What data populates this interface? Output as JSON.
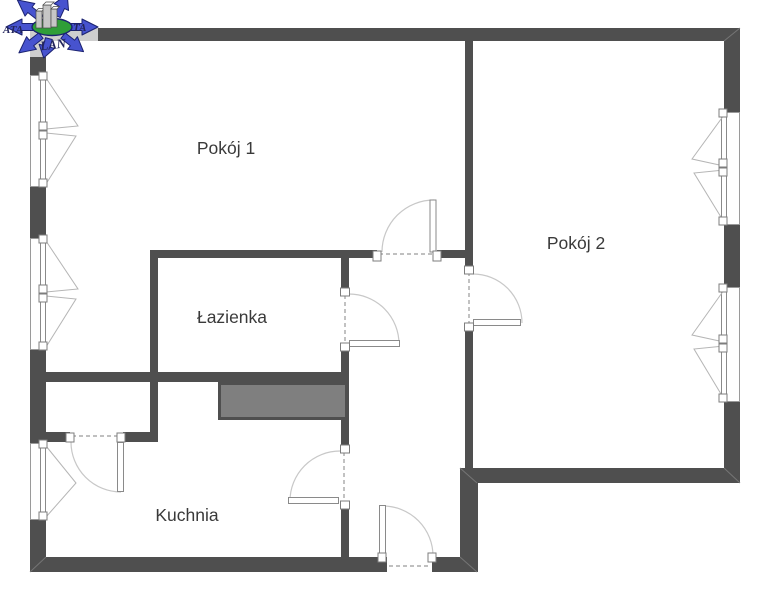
{
  "rooms": {
    "room1": {
      "label": "Pokój 1"
    },
    "room2": {
      "label": "Pokój 2"
    },
    "bathroom": {
      "label": "Łazienka"
    },
    "kitchen": {
      "label": "Kuchnia"
    }
  },
  "logo": {
    "fragment_left": "ATA",
    "fragment_right": "TA",
    "fragment_bottom": "LAN"
  },
  "colors": {
    "wall": "#4f4f4f",
    "duct": "#7f7f7f",
    "line": "#9a9a9a",
    "arc": "#c8c8c8",
    "labelc": "#3a3a3a",
    "logo_blue": "#4753cf",
    "logo_blue_dark": "#1b2270",
    "logo_green": "#2f9e38",
    "logo_text": "#23255c"
  }
}
